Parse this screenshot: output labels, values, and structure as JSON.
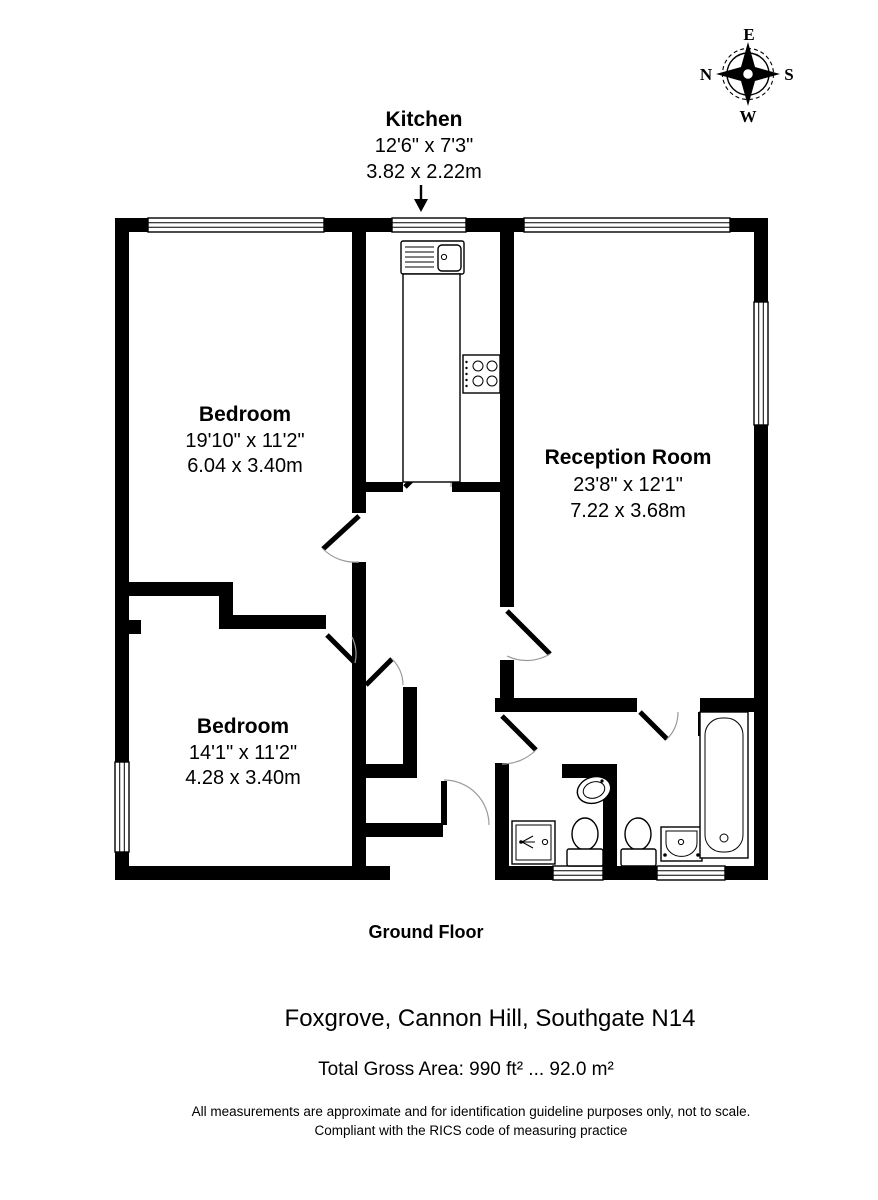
{
  "compass": {
    "north": "N",
    "east": "E",
    "south": "S",
    "west": "W"
  },
  "kitchen_callout": {
    "name": "Kitchen",
    "imperial": "12'6\" x 7'3\"",
    "metric": "3.82 x 2.22m"
  },
  "rooms": [
    {
      "name": "Bedroom",
      "imperial": "19'10\" x 11'2\"",
      "metric": "6.04 x 3.40m"
    },
    {
      "name": "Reception Room",
      "imperial": "23'8\" x 12'1\"",
      "metric": "7.22 x 3.68m"
    },
    {
      "name": "Bedroom",
      "imperial": "14'1\" x 11'2\"",
      "metric": "4.28 x 3.40m"
    }
  ],
  "footer": {
    "floor_label": "Ground Floor",
    "address": "Foxgrove, Cannon Hill, Southgate N14",
    "total_area": "Total Gross Area: 990 ft² ... 92.0 m²",
    "disclaimer_line1": "All measurements are approximate and for identification guideline purposes only, not to scale.",
    "disclaimer_line2": "Compliant with the RICS code of measuring practice"
  },
  "colors": {
    "wall": "#000000",
    "background": "#ffffff",
    "swing_arc": "#9a9a9a"
  }
}
